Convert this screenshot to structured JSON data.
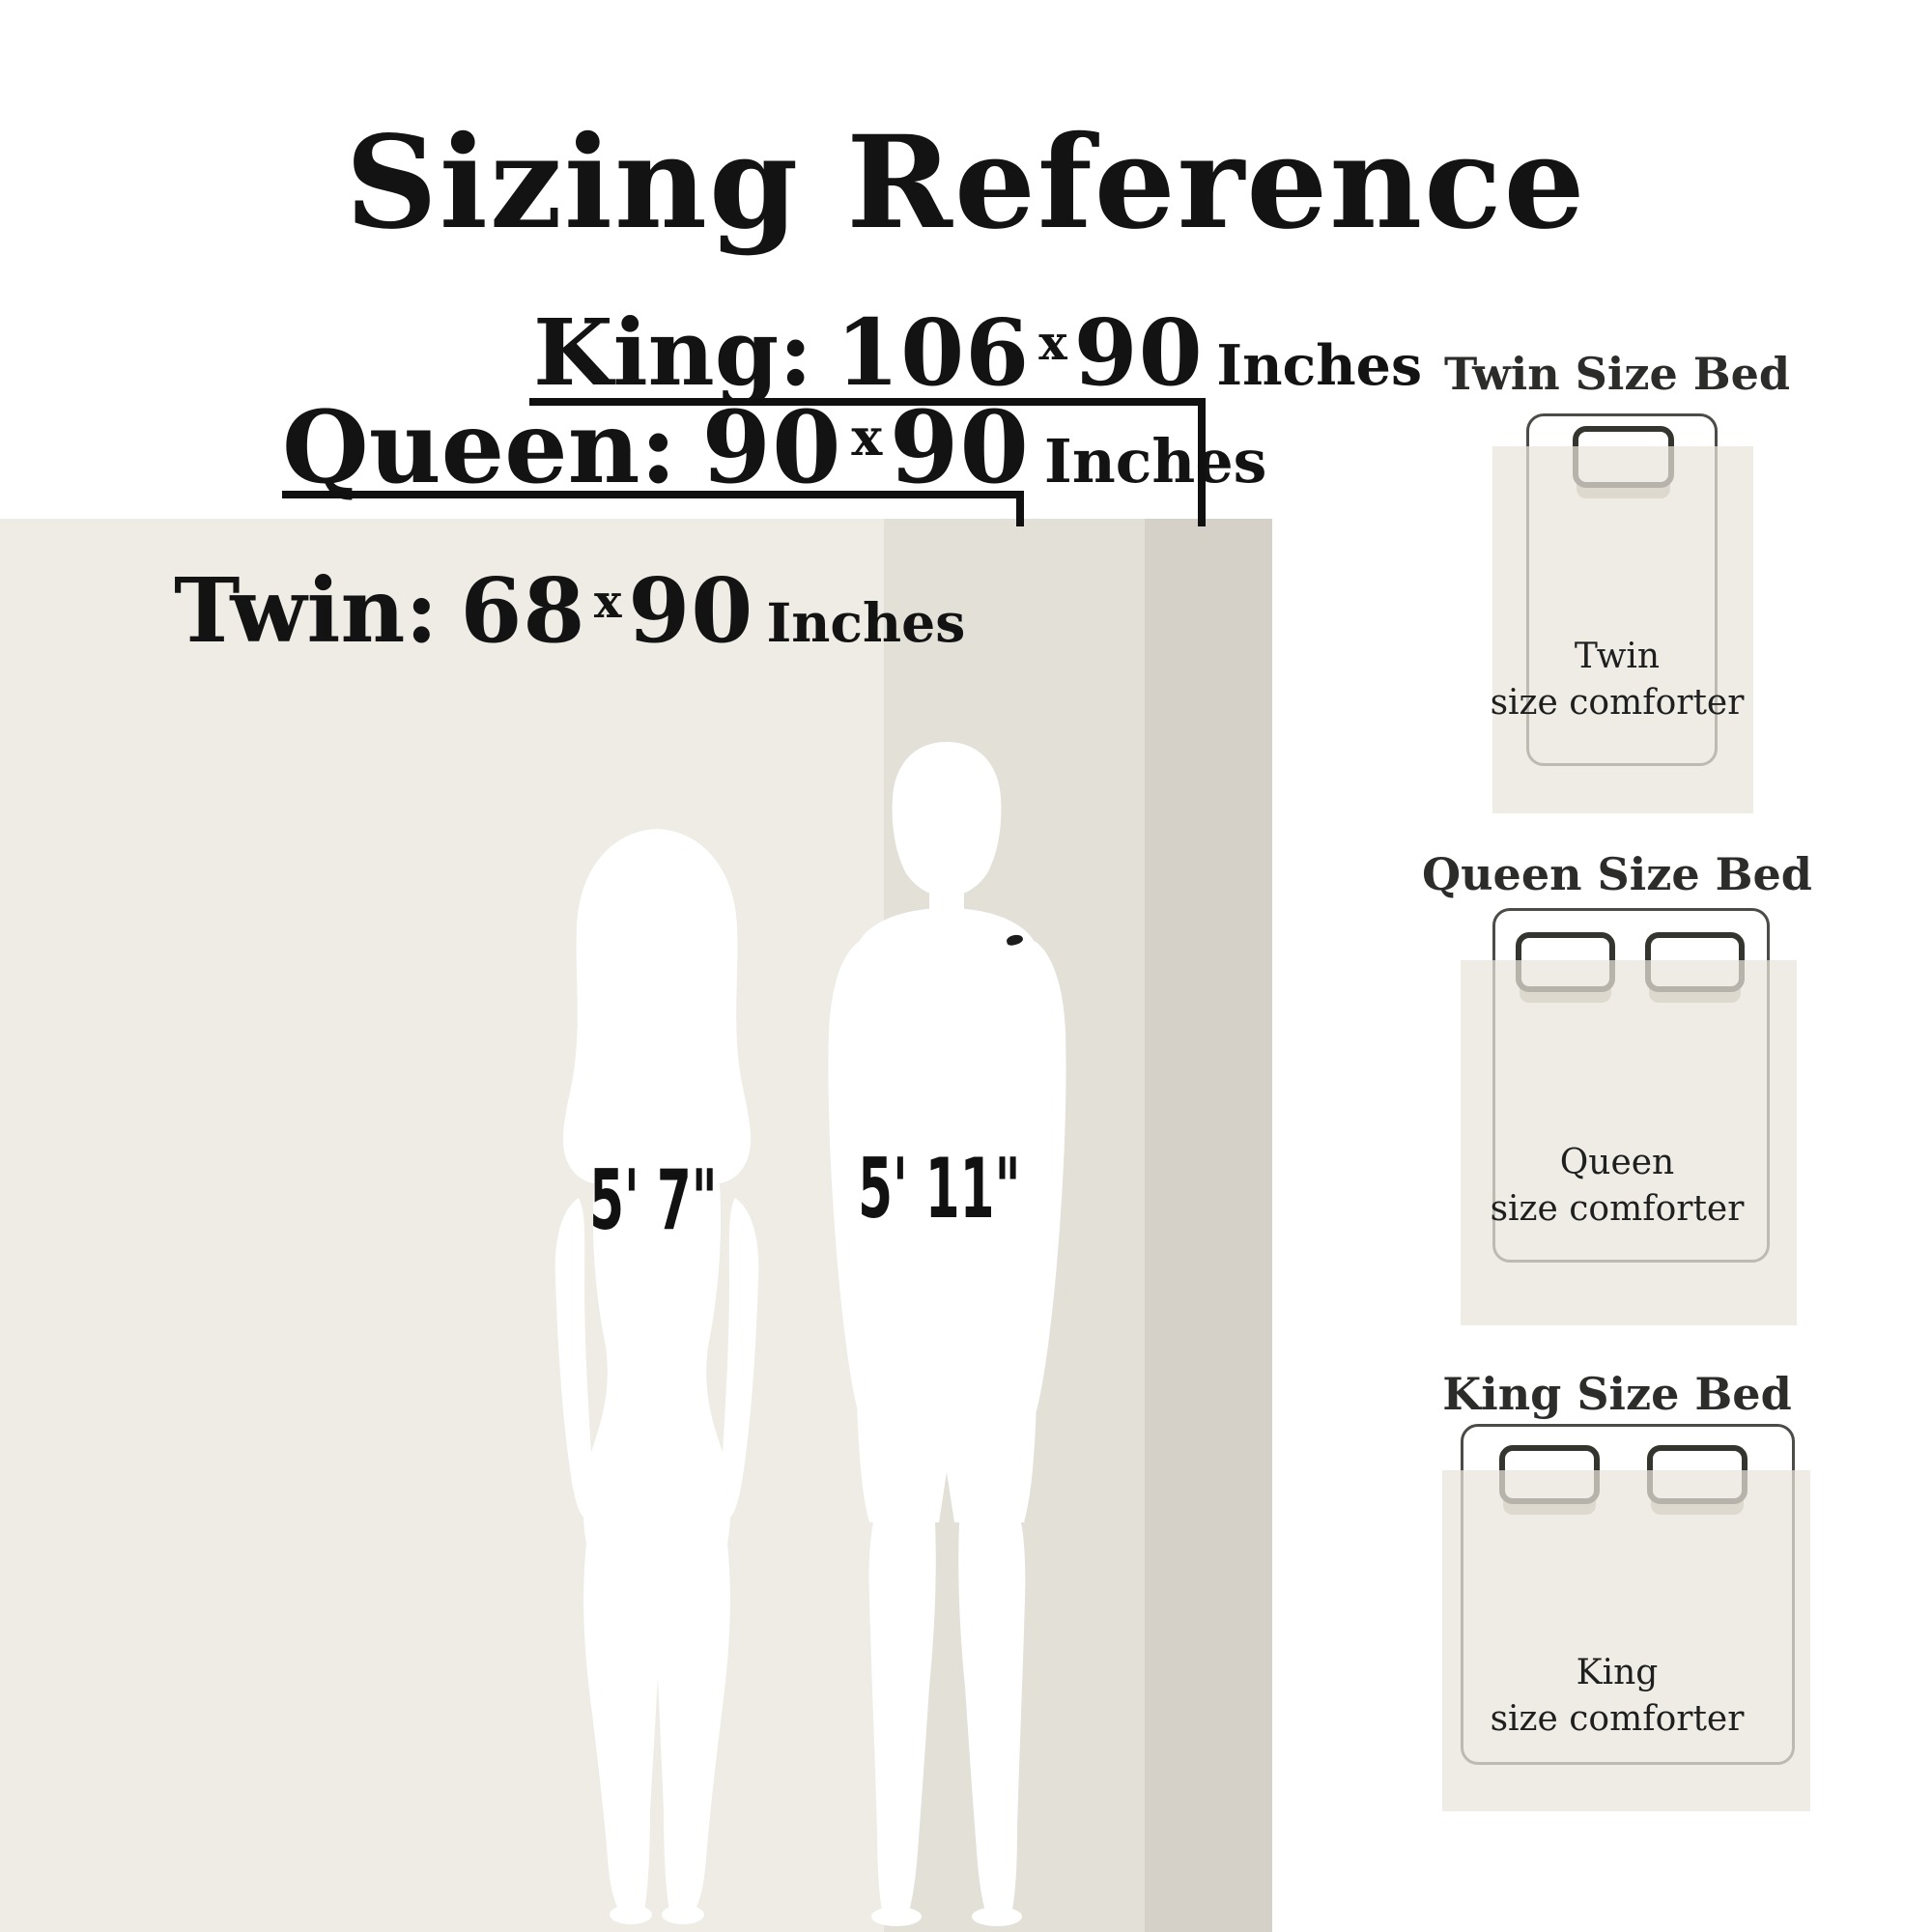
{
  "title": "Sizing Reference",
  "size_labels": [
    {
      "name": "King:",
      "width": "106",
      "times": "x",
      "height": "90",
      "unit": "Inches"
    },
    {
      "name": "Queen:",
      "width": "90",
      "times": "x",
      "height": "90",
      "unit": "Inches"
    },
    {
      "name": "Twin:",
      "width": "68",
      "times": "x",
      "height": "90",
      "unit": "Inches"
    }
  ],
  "figures": {
    "woman_height": "5' 7\"",
    "man_height": "5' 11\""
  },
  "beds": [
    {
      "title": "Twin Size Bed",
      "label_line1": "Twin",
      "label_line2": "size comforter"
    },
    {
      "title": "Queen Size Bed",
      "label_line1": "Queen",
      "label_line2": "size comforter"
    },
    {
      "title": "King Size Bed",
      "label_line1": "King",
      "label_line2": "size comforter"
    }
  ],
  "colors": {
    "background": "#ffffff",
    "text": "#141414",
    "twin_comforter_area": "#efece6",
    "queen_comforter_band": "#e3e0d8",
    "king_comforter_band": "#d5d1c9",
    "diagram_comforter_overlay": "#efece5",
    "silhouette": "#ffffff",
    "bed_outline": "#4b4b48",
    "pillow_outline": "#35352f",
    "pillow_shadow": "#bdb9b0",
    "bracket_line": "#101010"
  }
}
